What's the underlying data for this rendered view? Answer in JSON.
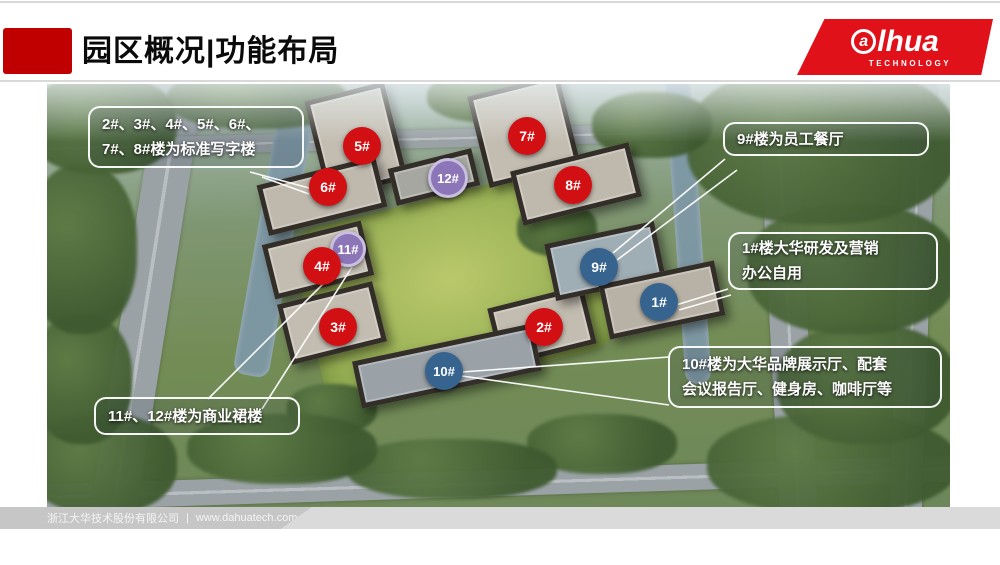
{
  "header": {
    "title": "园区概况|功能布局"
  },
  "logo": {
    "circled_letter": "a",
    "brand_rest": "lhua",
    "subtext": "TECHNOLOGY"
  },
  "map": {
    "markers": [
      {
        "label": "5#",
        "variant": "red",
        "x": 315,
        "y": 62,
        "size": 38
      },
      {
        "label": "7#",
        "variant": "red",
        "x": 480,
        "y": 52,
        "size": 38
      },
      {
        "label": "6#",
        "variant": "red",
        "x": 281,
        "y": 103,
        "size": 38
      },
      {
        "label": "12#",
        "variant": "purple",
        "x": 401,
        "y": 94,
        "size": 40
      },
      {
        "label": "8#",
        "variant": "red",
        "x": 526,
        "y": 101,
        "size": 38
      },
      {
        "label": "11#",
        "variant": "purple",
        "x": 301,
        "y": 165,
        "size": 36
      },
      {
        "label": "4#",
        "variant": "red",
        "x": 275,
        "y": 182,
        "size": 38
      },
      {
        "label": "9#",
        "variant": "blue",
        "x": 552,
        "y": 183,
        "size": 38
      },
      {
        "label": "1#",
        "variant": "blue",
        "x": 612,
        "y": 218,
        "size": 38
      },
      {
        "label": "3#",
        "variant": "red",
        "x": 291,
        "y": 243,
        "size": 38
      },
      {
        "label": "2#",
        "variant": "red",
        "x": 497,
        "y": 243,
        "size": 38
      },
      {
        "label": "10#",
        "variant": "blue",
        "x": 397,
        "y": 287,
        "size": 38
      }
    ],
    "callouts": [
      {
        "id": "standard-offices",
        "lines": [
          "2#、3#、4#、5#、6#、",
          "7#、8#楼为标准写字楼"
        ],
        "x": 41,
        "y": 22,
        "w": 216,
        "h": 62
      },
      {
        "id": "canteen",
        "lines": [
          "9#楼为员工餐厅"
        ],
        "x": 676,
        "y": 38,
        "w": 206,
        "h": 34
      },
      {
        "id": "hq-office",
        "lines": [
          "1#楼大华研发及营销",
          "办公自用"
        ],
        "x": 681,
        "y": 148,
        "w": 210,
        "h": 58
      },
      {
        "id": "showroom",
        "lines": [
          "10#楼为大华品牌展示厅、配套",
          "会议报告厅、健身房、咖啡厅等"
        ],
        "x": 621,
        "y": 262,
        "w": 274,
        "h": 62
      },
      {
        "id": "commercial-podium",
        "lines": [
          "11#、12#楼为商业裙楼"
        ],
        "x": 47,
        "y": 313,
        "w": 206,
        "h": 38
      }
    ],
    "leader_lines": [
      [
        203,
        88,
        262,
        104
      ],
      [
        215,
        93,
        262,
        110
      ],
      [
        298,
        178,
        161,
        315
      ],
      [
        305,
        183,
        215,
        325
      ],
      [
        678,
        75,
        566,
        169
      ],
      [
        690,
        86,
        570,
        176
      ],
      [
        681,
        205,
        629,
        221
      ],
      [
        684,
        211,
        632,
        226
      ],
      [
        415,
        288,
        622,
        273
      ],
      [
        415,
        292,
        622,
        321
      ]
    ]
  },
  "footer": {
    "company": "浙江大华技术股份有限公司",
    "separator": "|",
    "website": "www.dahuatech.com"
  },
  "colors": {
    "title_block_red": "#c00000",
    "logo_red": "#e01119",
    "marker_red": "#d21014",
    "marker_blue": "#36648f",
    "marker_purple": "#8d76b8",
    "marker_purple_ring": "#c9bfe0",
    "line_white": "#ffffff"
  }
}
